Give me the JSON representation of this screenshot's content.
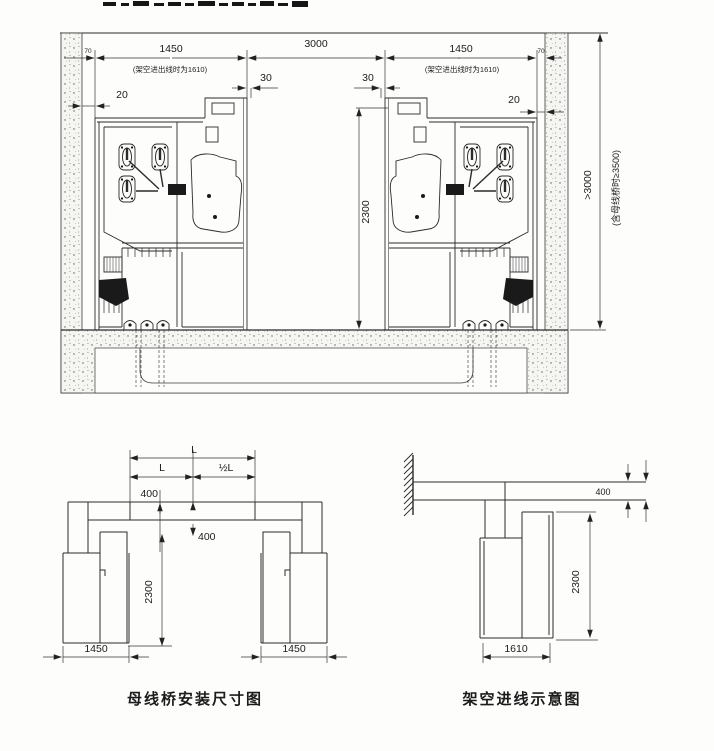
{
  "top_drawing": {
    "gap70_left": "70",
    "gap70_right": "70",
    "cab_width_left": "1450",
    "cab_width_right": "1450",
    "aisle_width": "3000",
    "overhead_note_left": "(架空进出线时为1610)",
    "overhead_note_right": "(架空进出线时为1610)",
    "clearance20_left": "20",
    "clearance20_right": "20",
    "offset30_left": "30",
    "offset30_right": "30",
    "cab_height": "2300",
    "room_height": ">3000",
    "room_height_note": "(含母线桥时≥3500)"
  },
  "bridge_figure": {
    "caption": "母线桥安装尺寸图",
    "span_total": "L",
    "span_left": "L",
    "span_half": "½L",
    "drop_top": "400",
    "drop_bottom": "400",
    "height": "2300",
    "width_left": "1450",
    "width_right": "1450"
  },
  "overhead_figure": {
    "caption": "架空进线示意图",
    "duct_height": "400",
    "height": "2300",
    "depth": "1610"
  }
}
